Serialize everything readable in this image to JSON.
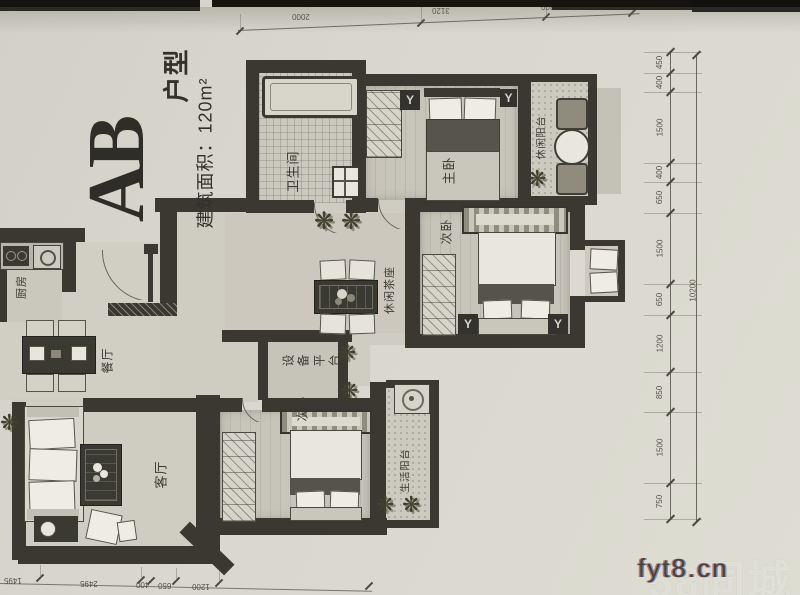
{
  "title": {
    "main": "AB",
    "suffix": "户型",
    "area": "建筑面积：120m²"
  },
  "rooms": {
    "bathroom": "卫生间",
    "master_bedroom": "主卧",
    "leisure_balcony": "休闲阳台",
    "bedroom_right": "次卧",
    "tea_area": "休闲茶座",
    "equipment_platform": "设备平台",
    "kitchen": "厨房",
    "dining": "餐厅",
    "living": "客厅",
    "bedroom_bottom": "次卧",
    "life_balcony": "生活阳台"
  },
  "dimensions": {
    "right_segments": [
      "450",
      "400",
      "1500",
      "400",
      "650",
      "1500",
      "650",
      "1200",
      "850",
      "1500",
      "750"
    ],
    "right_total": "10200",
    "top": [
      "2000",
      "3120",
      "1300"
    ],
    "bottom": [
      "1495",
      "2495",
      "400",
      "650",
      "1200"
    ]
  },
  "icons": {
    "ac_symbol": "Y",
    "plant": "❋"
  },
  "watermark": {
    "site": "fyt8.cn",
    "faint": "58同城"
  },
  "colors": {
    "paper": "#d8d6cd",
    "wall": "#3a3831",
    "text": "#3b3a32"
  }
}
